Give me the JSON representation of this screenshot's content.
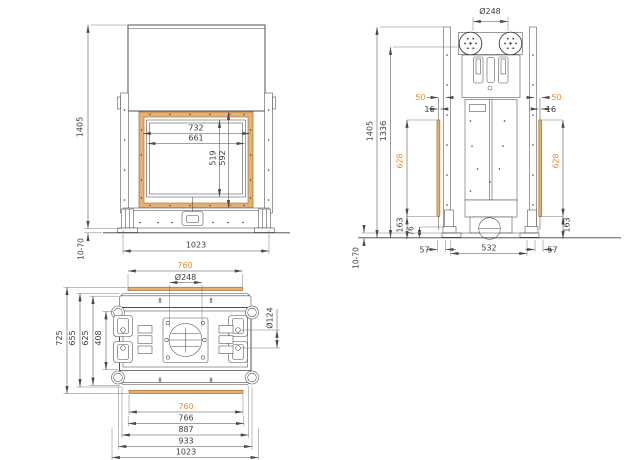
{
  "drawing": {
    "front": {
      "h1405": "1405",
      "adjust": "10-70",
      "w1023": "1023",
      "w732": "732",
      "w661": "661",
      "h519": "519",
      "h592": "592"
    },
    "side": {
      "dia248": "Ø248",
      "off50_left": "50",
      "off50_right": "50",
      "gap16_left": "16",
      "gap16_right": "16",
      "h1405": "1405",
      "h1336": "1336",
      "h628_left": "628",
      "h628_right": "628",
      "h163_left": "163",
      "h163_right": "163",
      "h76": "76",
      "d57_left": "57",
      "d532": "532",
      "d57_right": "57",
      "adjust": "10-70"
    },
    "top": {
      "w760_top": "760",
      "dia248": "Ø248",
      "dia124": "Ø124",
      "d725": "725",
      "d655": "655",
      "d625": "625",
      "d408": "408",
      "w760_bottom": "760",
      "w766": "766",
      "w887": "887",
      "w933": "933",
      "w1023": "1023"
    }
  },
  "colors": {
    "line": "#3d3d3d",
    "dim_line": "#4a4a4a",
    "accent_orange": "#ee8e2a",
    "glass_fill": "#e2b178",
    "glass_stroke": "#b27a34",
    "background": "#ffffff"
  }
}
